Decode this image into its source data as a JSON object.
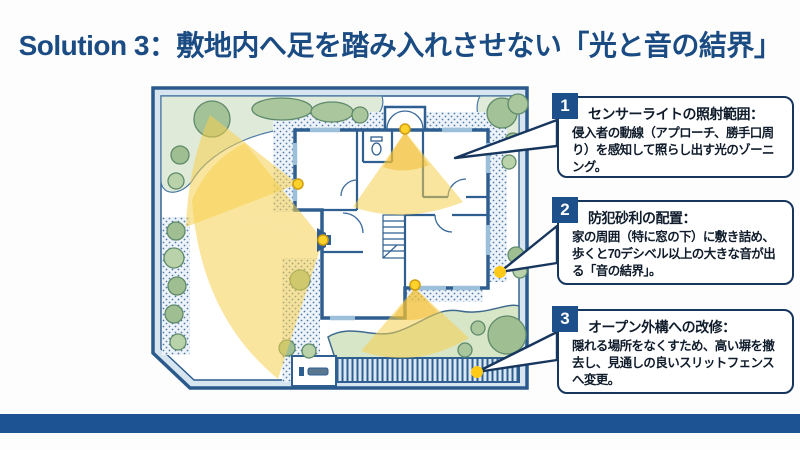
{
  "slide": {
    "title": "Solution 3：敷地内へ足を踏み入れさせない「光と音の結界」",
    "accent_color": "#1a4b82",
    "footer_bar_color": "#1d5293"
  },
  "annotations": [
    {
      "number": "1",
      "title": "センサーライトの照射範囲：",
      "body": "侵入者の動線（アプローチ、勝手口周り）を感知して照らし出す光のゾーニング。"
    },
    {
      "number": "2",
      "title": "防犯砂利の配置：",
      "body": "家の周囲（特に窓の下）に敷き詰め、歩くと70デシベル以上の大きな音が出る「音の結界」。"
    },
    {
      "number": "3",
      "title": "オープン外構への改修：",
      "body": "隠れる場所をなくすため、高い塀を撤去し、見通しの良いスリットフェンスへ変更。"
    }
  ],
  "site_plan": {
    "sensor_light_count": 4,
    "callout_marker_count": 2,
    "cone_color": "#f6d04f",
    "sensor_dot_color": "#ffd12b",
    "marker_dot_color": "#ffc917",
    "wall_color": "#2f5f90",
    "gravel_dot_color": "#4f7cab",
    "lawn_color": "#d8e6c8",
    "tree_color": "#a3c297"
  }
}
